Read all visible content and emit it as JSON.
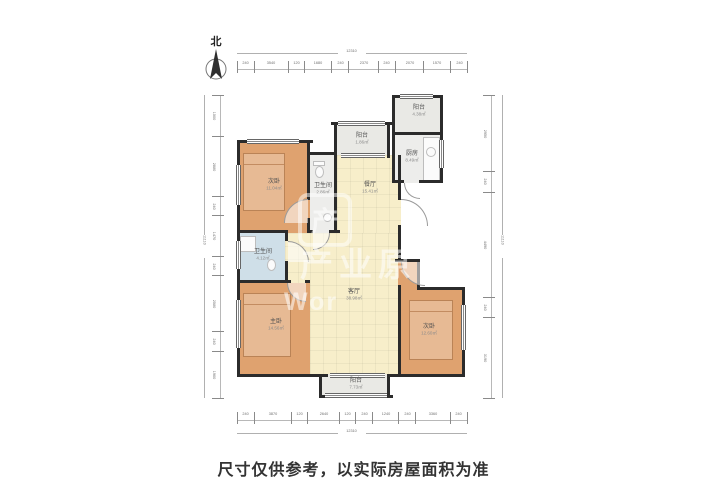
{
  "compass": {
    "label": "北"
  },
  "caption": "尺寸仅供参考，以实际房屋面积为准",
  "watermark": {
    "logo_glyph": "产",
    "brand_text": "产业原",
    "latin_text": "Wor"
  },
  "colors": {
    "bedroom_fill": "#dfa26f",
    "living_fill": "#f7eeca",
    "bath_fill": "#cfdfe8",
    "balcony_fill": "#e9e9e5",
    "kitchen_fill": "#ededeb",
    "wall": "#2b2b2b",
    "caption_text": "#333333",
    "dimension_text": "#6f6f6f"
  },
  "rooms": [
    {
      "id": "bedroom-top-left",
      "name": "次卧",
      "area": "11.04㎡"
    },
    {
      "id": "bathroom-small",
      "name": "卫生间",
      "area": "2.86㎡"
    },
    {
      "id": "balcony-top",
      "name": "阳台",
      "area": "1.86㎡"
    },
    {
      "id": "dining-room",
      "name": "餐厅",
      "area": "15.41㎡"
    },
    {
      "id": "balcony-top-right",
      "name": "阳台",
      "area": "4.38㎡"
    },
    {
      "id": "kitchen",
      "name": "厨房",
      "area": "8.49㎡"
    },
    {
      "id": "bathroom-left",
      "name": "卫生间",
      "area": "4.12㎡"
    },
    {
      "id": "master-bedroom",
      "name": "主卧",
      "area": "14.56㎡"
    },
    {
      "id": "living-room",
      "name": "客厅",
      "area": "38.98㎡"
    },
    {
      "id": "bedroom-bottom-right",
      "name": "次卧",
      "area": "12.60㎡"
    },
    {
      "id": "balcony-bottom",
      "name": "阳台",
      "area": "7.73㎡"
    }
  ],
  "dimensions": {
    "top": {
      "total": "12310",
      "segments": [
        "240",
        "3540",
        "120",
        "1680",
        "240",
        "2370",
        "240",
        "2070",
        "1570",
        "240"
      ]
    },
    "bottom": {
      "total": "12310",
      "segments": [
        "240",
        "3870",
        "120",
        "2640",
        "120",
        "240",
        "1240",
        "240",
        "3360",
        "240"
      ]
    },
    "left": {
      "total": "11110",
      "segments": [
        "1500",
        "2880",
        "240",
        "1470",
        "240",
        "2580",
        "240",
        "1960"
      ]
    },
    "right": {
      "total": "11110",
      "segments": [
        "2950",
        "240",
        "4490",
        "240",
        "3190"
      ]
    }
  }
}
